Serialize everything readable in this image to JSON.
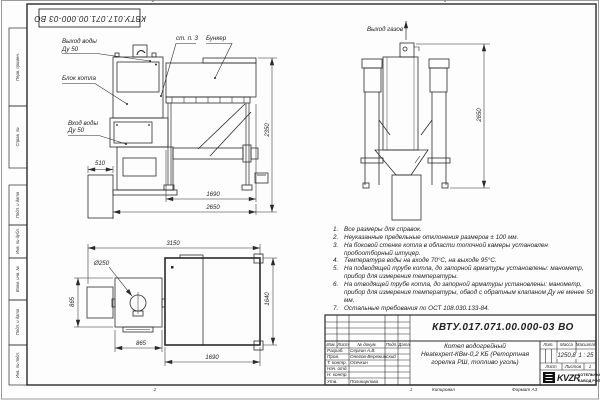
{
  "stamp": {
    "code_top_left": "КВТУ.017.071.00.000-03 ВО"
  },
  "margin_column": {
    "labels": [
      "Перв. примен.",
      "Справ. №",
      "Подп. и дата",
      "Инв. № дубл.",
      "Взам. инв. №",
      "Подп. и дата",
      "Инв. № подл."
    ]
  },
  "zones": {
    "top_2": "2",
    "top_1": "1",
    "bottom_2": "2",
    "bottom_1": "1"
  },
  "front_view": {
    "water_outlet_label_1": "Выход воды",
    "water_outlet_label_2": "Ду 50",
    "boiler_block_label": "Блок котла",
    "water_inlet_label_1": "Вход воды",
    "water_inlet_label_2": "Ду 50",
    "wall_item_label": "ст. п. 3",
    "hopper_label": "Бункер",
    "dim_510": "510",
    "dim_1690": "1690",
    "dim_2650": "2650",
    "dim_height_2350": "2350"
  },
  "side_view": {
    "gas_outlet_label": "Выход газов",
    "dim_height_2650": "2650"
  },
  "plan_view": {
    "chimney_label": "Ø250",
    "dim_3150": "3150",
    "dim_865_left": "865",
    "dim_865_bottom": "865",
    "dim_1690": "1690",
    "dim_1640": "1640"
  },
  "notes": [
    {
      "num": "1.",
      "text": "Все размеры для справок."
    },
    {
      "num": "2.",
      "text": "Неуказанные предельные отклонения размеров ± 100 мм."
    },
    {
      "num": "3.",
      "text": "На боковой стенке котла в области топочной камеры установлен пробоотборный штуцер."
    },
    {
      "num": "4.",
      "text": "Температура воды на входе 70°С, на выходе 95°С."
    },
    {
      "num": "5.",
      "text": "На подводящей трубе котла, до запорной арматуры установлены: манометр, прибор для измерения температуры."
    },
    {
      "num": "6.",
      "text": "На отводящей трубе котла, до запорной арматуры установлены: манометр, прибор для измерения температуры, обвод с обратным клапаном Ду не менее 50 мм."
    },
    {
      "num": "7.",
      "text": "Остальные требования по ОСТ 108.030.133-84."
    }
  ],
  "title_block": {
    "doc_number": "КВТУ.017.071.00.000-03 ВО",
    "product_title_1": "Котел водогрейный",
    "product_title_2": "Heatexpert-КВм-0,2 КБ (Ретортная",
    "product_title_3": "горелка РШ, топливо уголь)",
    "header": {
      "izm": "Изм.",
      "list": "Лист",
      "doc": "№ докум.",
      "podp": "Подп.",
      "data": "Дата"
    },
    "rows": [
      {
        "role": "Разраб.",
        "name": "Сергин А.В."
      },
      {
        "role": "Пров.",
        "name": "Онегов-Вережинский"
      },
      {
        "role": "Т. контр.",
        "name": "Осечкин"
      },
      {
        "role": "Нач. отд.",
        "name": ""
      },
      {
        "role": "Н. контр.",
        "name": ""
      },
      {
        "role": "Утв.",
        "name": "Поликарпова"
      }
    ],
    "lit_label": "Лит.",
    "mass_label": "Масса",
    "scale_label": "Масштаб",
    "mass_value": "1250,8",
    "scale_value": "1 : 25",
    "sheet_label": "Лист",
    "sheets_label": "Листов",
    "sheets_value": "1",
    "logo_brand": "KVZR",
    "logo_org_1": "КОТЕЛЬНЫЙ",
    "logo_org_2": "ЗАВОД РЭП"
  },
  "footer": {
    "copied_label": "Копировал",
    "format_label": "Формат А3"
  },
  "colors": {
    "line": "#2b2b2b",
    "paper": "#fdfdfd"
  }
}
